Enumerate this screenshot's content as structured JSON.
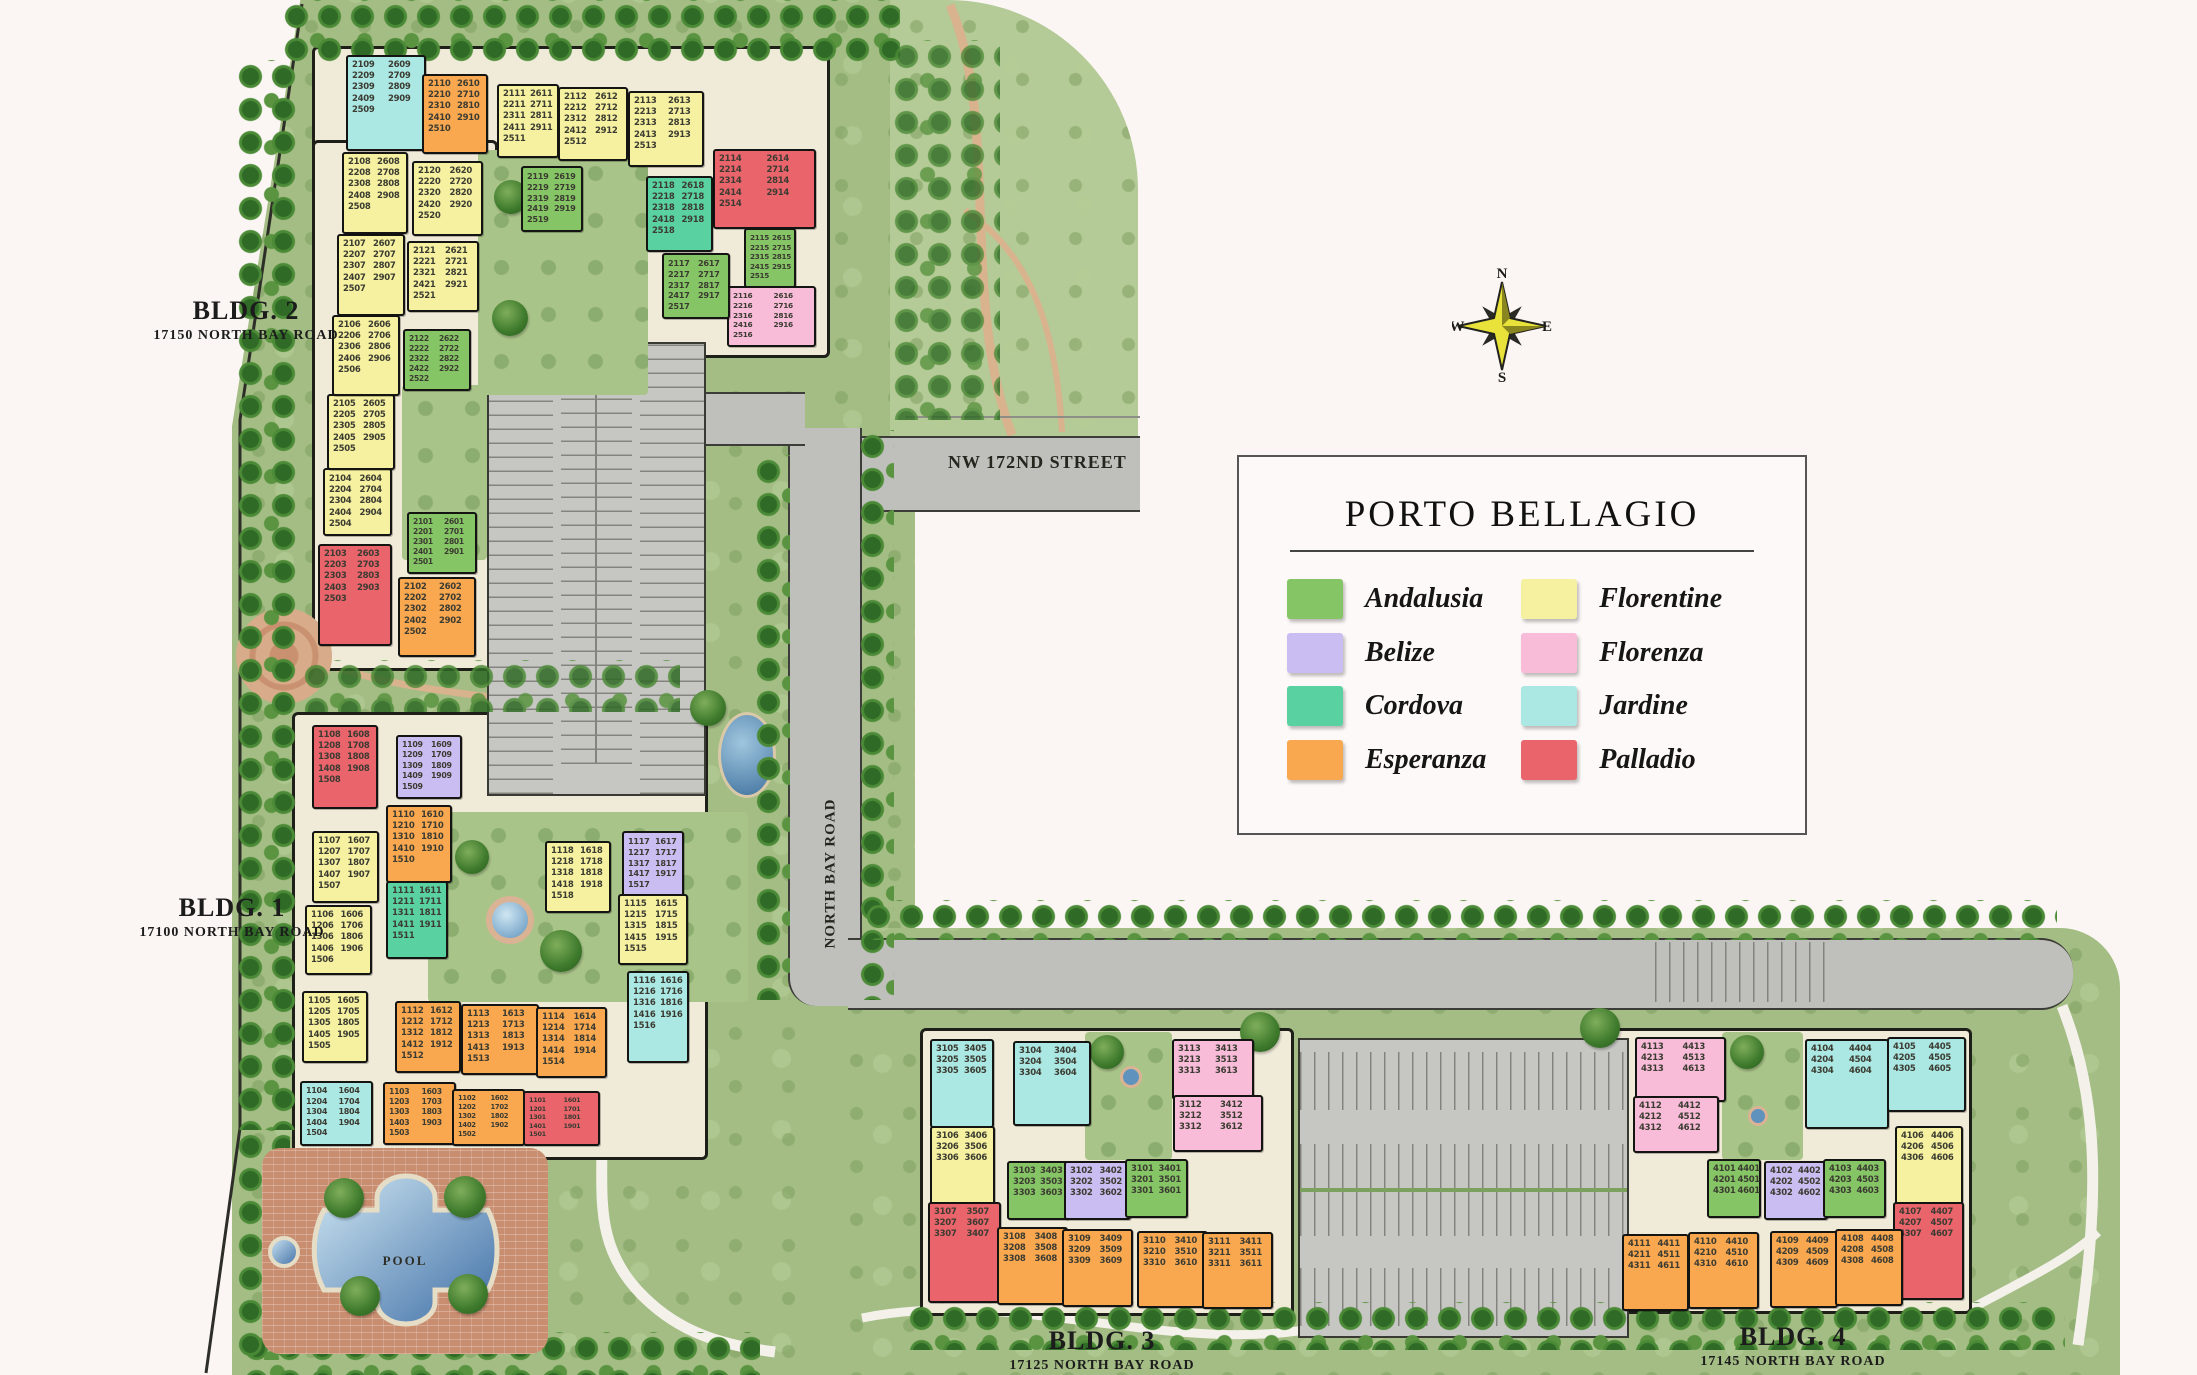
{
  "title": "PORTO BELLAGIO",
  "legend": {
    "title": "PORTO BELLAGIO",
    "entries": [
      {
        "name": "Andalusia",
        "color": "#85c565"
      },
      {
        "name": "Belize",
        "color": "#c9bdf1"
      },
      {
        "name": "Cordova",
        "color": "#5ad1a1"
      },
      {
        "name": "Esperanza",
        "color": "#f9a850"
      },
      {
        "name": "Florentine",
        "color": "#f5f1a0"
      },
      {
        "name": "Florenza",
        "color": "#f8bcd9"
      },
      {
        "name": "Jardine",
        "color": "#abe8e4"
      },
      {
        "name": "Palladio",
        "color": "#ea646c"
      }
    ]
  },
  "streets": {
    "nw_172nd": "NW 172ND STREET",
    "north_bay": "NORTH BAY ROAD"
  },
  "pool": {
    "label": "POOL"
  },
  "compass": {
    "n": "N",
    "e": "E",
    "s": "S",
    "w": "W"
  },
  "buildings": [
    {
      "id": "bldg-2",
      "label": "BLDG. 2",
      "address": "17150 NORTH BAY ROAD",
      "label_x": 246,
      "label_y": 296
    },
    {
      "id": "bldg-1",
      "label": "BLDG. 1",
      "address": "17100 NORTH BAY ROAD",
      "label_x": 232,
      "label_y": 893
    },
    {
      "id": "bldg-3",
      "label": "BLDG. 3",
      "address": "17125 NORTH BAY ROAD",
      "label_x": 1102,
      "label_y": 1326
    },
    {
      "id": "bldg-4",
      "label": "BLDG. 4",
      "address": "17145 NORTH BAY ROAD",
      "label_x": 1793,
      "label_y": 1322
    }
  ],
  "unit_blocks": [
    {
      "building": "bldg-2",
      "type": "Andalusia",
      "x": 407,
      "y": 512,
      "w": 66,
      "h": 58,
      "units": [
        "2101",
        "2601",
        "2201",
        "2701",
        "2301",
        "2801",
        "2401",
        "2901",
        "2501"
      ]
    },
    {
      "building": "bldg-2",
      "type": "Esperanza",
      "x": 398,
      "y": 577,
      "w": 74,
      "h": 76,
      "units": [
        "2102",
        "2602",
        "2202",
        "2702",
        "2302",
        "2802",
        "2402",
        "2902",
        "2502"
      ]
    },
    {
      "building": "bldg-2",
      "type": "Palladio",
      "x": 318,
      "y": 544,
      "w": 70,
      "h": 98,
      "units": [
        "2103",
        "2603",
        "2203",
        "2703",
        "2303",
        "2803",
        "2403",
        "2903",
        "2503"
      ]
    },
    {
      "building": "bldg-2",
      "type": "Florentine",
      "x": 323,
      "y": 468,
      "w": 65,
      "h": 64,
      "units": [
        "2104",
        "2604",
        "2204",
        "2704",
        "2304",
        "2804",
        "2404",
        "2904",
        "2504"
      ]
    },
    {
      "building": "bldg-2",
      "type": "Florentine",
      "x": 327,
      "y": 394,
      "w": 64,
      "h": 72,
      "units": [
        "2105",
        "2605",
        "2205",
        "2705",
        "2305",
        "2805",
        "2405",
        "2905",
        "2505"
      ]
    },
    {
      "building": "bldg-2",
      "type": "Florentine",
      "x": 332,
      "y": 315,
      "w": 64,
      "h": 77,
      "units": [
        "2106",
        "2606",
        "2206",
        "2706",
        "2306",
        "2806",
        "2406",
        "2906",
        "2506"
      ]
    },
    {
      "building": "bldg-2",
      "type": "Florentine",
      "x": 337,
      "y": 234,
      "w": 64,
      "h": 78,
      "units": [
        "2107",
        "2607",
        "2207",
        "2707",
        "2307",
        "2807",
        "2407",
        "2907",
        "2507"
      ]
    },
    {
      "building": "bldg-2",
      "type": "Florentine",
      "x": 342,
      "y": 152,
      "w": 62,
      "h": 78,
      "units": [
        "2108",
        "2608",
        "2208",
        "2708",
        "2308",
        "2808",
        "2408",
        "2908",
        "2508"
      ]
    },
    {
      "building": "bldg-2",
      "type": "Jardine",
      "x": 346,
      "y": 55,
      "w": 76,
      "h": 92,
      "units": [
        "2109",
        "2609",
        "2209",
        "2709",
        "2309",
        "2809",
        "2409",
        "2909",
        "2509"
      ]
    },
    {
      "building": "bldg-2",
      "type": "Esperanza",
      "x": 422,
      "y": 74,
      "w": 62,
      "h": 76,
      "units": [
        "2110",
        "2610",
        "2210",
        "2710",
        "2310",
        "2810",
        "2410",
        "2910",
        "2510"
      ]
    },
    {
      "building": "bldg-2",
      "type": "Florentine",
      "x": 497,
      "y": 84,
      "w": 58,
      "h": 70,
      "units": [
        "2111",
        "2611",
        "2211",
        "2711",
        "2311",
        "2811",
        "2411",
        "2911",
        "2511"
      ]
    },
    {
      "building": "bldg-2",
      "type": "Florentine",
      "x": 558,
      "y": 87,
      "w": 66,
      "h": 70,
      "units": [
        "2112",
        "2612",
        "2212",
        "2712",
        "2312",
        "2812",
        "2412",
        "2912",
        "2512"
      ]
    },
    {
      "building": "bldg-2",
      "type": "Florentine",
      "x": 628,
      "y": 91,
      "w": 72,
      "h": 72,
      "units": [
        "2113",
        "2613",
        "2213",
        "2713",
        "2313",
        "2813",
        "2413",
        "2913",
        "2513"
      ]
    },
    {
      "building": "bldg-2",
      "type": "Palladio",
      "x": 713,
      "y": 149,
      "w": 99,
      "h": 76,
      "units": [
        "2114",
        "2614",
        "2214",
        "2714",
        "2314",
        "2814",
        "2414",
        "2914",
        "2514"
      ]
    },
    {
      "building": "bldg-2",
      "type": "Andalusia",
      "x": 744,
      "y": 228,
      "w": 48,
      "h": 56,
      "units": [
        "2115",
        "2615",
        "2215",
        "2715",
        "2315",
        "2815",
        "2415",
        "2915",
        "2515"
      ]
    },
    {
      "building": "bldg-2",
      "type": "Florenza",
      "x": 727,
      "y": 286,
      "w": 85,
      "h": 57,
      "units": [
        "2116",
        "2616",
        "2216",
        "2716",
        "2316",
        "2816",
        "2416",
        "2916",
        "2516"
      ]
    },
    {
      "building": "bldg-2",
      "type": "Andalusia",
      "x": 662,
      "y": 253,
      "w": 64,
      "h": 62,
      "units": [
        "2117",
        "2617",
        "2217",
        "2717",
        "2317",
        "2817",
        "2417",
        "2917",
        "2517"
      ]
    },
    {
      "building": "bldg-2",
      "type": "Cordova",
      "x": 646,
      "y": 176,
      "w": 63,
      "h": 72,
      "units": [
        "2118",
        "2618",
        "2218",
        "2718",
        "2318",
        "2818",
        "2418",
        "2918",
        "2518"
      ]
    },
    {
      "building": "bldg-2",
      "type": "Andalusia",
      "x": 521,
      "y": 166,
      "w": 58,
      "h": 62,
      "units": [
        "2119",
        "2619",
        "2219",
        "2719",
        "2319",
        "2819",
        "2419",
        "2919",
        "2519"
      ]
    },
    {
      "building": "bldg-2",
      "type": "Florentine",
      "x": 412,
      "y": 161,
      "w": 67,
      "h": 71,
      "units": [
        "2120",
        "2620",
        "2220",
        "2720",
        "2320",
        "2820",
        "2420",
        "2920",
        "2520"
      ]
    },
    {
      "building": "bldg-2",
      "type": "Florentine",
      "x": 407,
      "y": 241,
      "w": 68,
      "h": 67,
      "units": [
        "2121",
        "2621",
        "2221",
        "2721",
        "2321",
        "2821",
        "2421",
        "2921",
        "2521"
      ]
    },
    {
      "building": "bldg-2",
      "type": "Andalusia",
      "x": 403,
      "y": 329,
      "w": 64,
      "h": 58,
      "units": [
        "2122",
        "2622",
        "2222",
        "2722",
        "2322",
        "2822",
        "2422",
        "2922",
        "2522"
      ]
    },
    {
      "building": "bldg-1",
      "type": "Palladio",
      "x": 312,
      "y": 725,
      "w": 62,
      "h": 80,
      "units": [
        "1108",
        "1608",
        "1208",
        "1708",
        "1308",
        "1808",
        "1408",
        "1908",
        "1508"
      ]
    },
    {
      "building": "bldg-1",
      "type": "Belize",
      "x": 396,
      "y": 735,
      "w": 62,
      "h": 60,
      "units": [
        "1109",
        "1609",
        "1209",
        "1709",
        "1309",
        "1809",
        "1409",
        "1909",
        "1509"
      ]
    },
    {
      "building": "bldg-1",
      "type": "Esperanza",
      "x": 386,
      "y": 805,
      "w": 62,
      "h": 74,
      "units": [
        "1110",
        "1610",
        "1210",
        "1710",
        "1310",
        "1810",
        "1410",
        "1910",
        "1510"
      ]
    },
    {
      "building": "bldg-1",
      "type": "Cordova",
      "x": 386,
      "y": 881,
      "w": 58,
      "h": 74,
      "units": [
        "1111",
        "1611",
        "1211",
        "1711",
        "1311",
        "1811",
        "1411",
        "1911",
        "1511"
      ]
    },
    {
      "building": "bldg-1",
      "type": "Florentine",
      "x": 312,
      "y": 831,
      "w": 63,
      "h": 68,
      "units": [
        "1107",
        "1607",
        "1207",
        "1707",
        "1307",
        "1807",
        "1407",
        "1907",
        "1507"
      ]
    },
    {
      "building": "bldg-1",
      "type": "Florentine",
      "x": 305,
      "y": 905,
      "w": 63,
      "h": 66,
      "units": [
        "1106",
        "1606",
        "1206",
        "1706",
        "1306",
        "1806",
        "1406",
        "1906",
        "1506"
      ]
    },
    {
      "building": "bldg-1",
      "type": "Florentine",
      "x": 302,
      "y": 991,
      "w": 62,
      "h": 68,
      "units": [
        "1105",
        "1605",
        "1205",
        "1705",
        "1305",
        "1805",
        "1405",
        "1905",
        "1505"
      ]
    },
    {
      "building": "bldg-1",
      "type": "Florentine",
      "x": 545,
      "y": 841,
      "w": 62,
      "h": 68,
      "units": [
        "1118",
        "1618",
        "1218",
        "1718",
        "1318",
        "1818",
        "1418",
        "1918",
        "1518"
      ]
    },
    {
      "building": "bldg-1",
      "type": "Belize",
      "x": 622,
      "y": 831,
      "w": 58,
      "h": 62,
      "units": [
        "1117",
        "1617",
        "1217",
        "1717",
        "1317",
        "1817",
        "1417",
        "1917",
        "1517"
      ]
    },
    {
      "building": "bldg-1",
      "type": "Florentine",
      "x": 618,
      "y": 894,
      "w": 66,
      "h": 67,
      "units": [
        "1115",
        "1615",
        "1215",
        "1715",
        "1315",
        "1815",
        "1415",
        "1915",
        "1515"
      ]
    },
    {
      "building": "bldg-1",
      "type": "Jardine",
      "x": 627,
      "y": 971,
      "w": 58,
      "h": 88,
      "units": [
        "1116",
        "1616",
        "1216",
        "1716",
        "1316",
        "1816",
        "1416",
        "1916",
        "1516"
      ]
    },
    {
      "building": "bldg-1",
      "type": "Esperanza",
      "x": 395,
      "y": 1001,
      "w": 62,
      "h": 68,
      "units": [
        "1112",
        "1612",
        "1212",
        "1712",
        "1312",
        "1812",
        "1412",
        "1912",
        "1512"
      ]
    },
    {
      "building": "bldg-1",
      "type": "Esperanza",
      "x": 461,
      "y": 1004,
      "w": 74,
      "h": 67,
      "units": [
        "1113",
        "1613",
        "1213",
        "1713",
        "1313",
        "1813",
        "1413",
        "1913",
        "1513"
      ]
    },
    {
      "building": "bldg-1",
      "type": "Esperanza",
      "x": 536,
      "y": 1007,
      "w": 67,
      "h": 67,
      "units": [
        "1114",
        "1614",
        "1214",
        "1714",
        "1314",
        "1814",
        "1414",
        "1914",
        "1514"
      ]
    },
    {
      "building": "bldg-1",
      "type": "Jardine",
      "x": 300,
      "y": 1081,
      "w": 69,
      "h": 61,
      "units": [
        "1104",
        "1604",
        "1204",
        "1704",
        "1304",
        "1804",
        "1404",
        "1904",
        "1504"
      ]
    },
    {
      "building": "bldg-1",
      "type": "Esperanza",
      "x": 383,
      "y": 1082,
      "w": 69,
      "h": 59,
      "units": [
        "1103",
        "1603",
        "1203",
        "1703",
        "1303",
        "1803",
        "1403",
        "1903",
        "1503"
      ]
    },
    {
      "building": "bldg-1",
      "type": "Esperanza",
      "x": 452,
      "y": 1089,
      "w": 69,
      "h": 53,
      "units": [
        "1102",
        "1602",
        "1202",
        "1702",
        "1302",
        "1802",
        "1402",
        "1902",
        "1502"
      ]
    },
    {
      "building": "bldg-1",
      "type": "Palladio",
      "x": 523,
      "y": 1091,
      "w": 73,
      "h": 51,
      "units": [
        "1101",
        "1601",
        "1201",
        "1701",
        "1301",
        "1801",
        "1401",
        "1901",
        "1501"
      ]
    },
    {
      "building": "bldg-3",
      "type": "Jardine",
      "x": 930,
      "y": 1039,
      "w": 60,
      "h": 85,
      "units": [
        "3105",
        "3405",
        "3205",
        "3505",
        "3305",
        "3605"
      ]
    },
    {
      "building": "bldg-3",
      "type": "Jardine",
      "x": 1013,
      "y": 1041,
      "w": 74,
      "h": 81,
      "units": [
        "3104",
        "3404",
        "3204",
        "3504",
        "3304",
        "3604"
      ]
    },
    {
      "building": "bldg-3",
      "type": "Florenza",
      "x": 1172,
      "y": 1039,
      "w": 78,
      "h": 57,
      "units": [
        "3113",
        "3413",
        "3213",
        "3513",
        "3313",
        "3613"
      ]
    },
    {
      "building": "bldg-3",
      "type": "Florenza",
      "x": 1173,
      "y": 1095,
      "w": 86,
      "h": 53,
      "units": [
        "3112",
        "3412",
        "3212",
        "3512",
        "3312",
        "3612"
      ]
    },
    {
      "building": "bldg-3",
      "type": "Florentine",
      "x": 930,
      "y": 1126,
      "w": 61,
      "h": 77,
      "units": [
        "3106",
        "3406",
        "3206",
        "3506",
        "3306",
        "3606"
      ]
    },
    {
      "building": "bldg-3",
      "type": "Palladio",
      "x": 928,
      "y": 1202,
      "w": 69,
      "h": 97,
      "units": [
        "3107",
        "3507",
        "3207",
        "3607",
        "3307",
        "3407"
      ]
    },
    {
      "building": "bldg-3",
      "type": "Andalusia",
      "x": 1007,
      "y": 1161,
      "w": 58,
      "h": 55,
      "units": [
        "3103",
        "3403",
        "3203",
        "3503",
        "3303",
        "3603"
      ]
    },
    {
      "building": "bldg-3",
      "type": "Belize",
      "x": 1064,
      "y": 1161,
      "w": 63,
      "h": 55,
      "units": [
        "3102",
        "3402",
        "3202",
        "3502",
        "3302",
        "3602"
      ]
    },
    {
      "building": "bldg-3",
      "type": "Andalusia",
      "x": 1125,
      "y": 1159,
      "w": 59,
      "h": 55,
      "units": [
        "3101",
        "3401",
        "3201",
        "3501",
        "3301",
        "3601"
      ]
    },
    {
      "building": "bldg-3",
      "type": "Esperanza",
      "x": 997,
      "y": 1227,
      "w": 67,
      "h": 74,
      "units": [
        "3108",
        "3408",
        "3208",
        "3508",
        "3308",
        "3608"
      ]
    },
    {
      "building": "bldg-3",
      "type": "Esperanza",
      "x": 1062,
      "y": 1229,
      "w": 67,
      "h": 74,
      "units": [
        "3109",
        "3409",
        "3209",
        "3509",
        "3309",
        "3609"
      ]
    },
    {
      "building": "bldg-3",
      "type": "Esperanza",
      "x": 1137,
      "y": 1231,
      "w": 67,
      "h": 73,
      "units": [
        "3110",
        "3410",
        "3210",
        "3510",
        "3310",
        "3610"
      ]
    },
    {
      "building": "bldg-3",
      "type": "Esperanza",
      "x": 1202,
      "y": 1232,
      "w": 67,
      "h": 73,
      "units": [
        "3111",
        "3411",
        "3211",
        "3511",
        "3311",
        "3611"
      ]
    },
    {
      "building": "bldg-4",
      "type": "Florenza",
      "x": 1635,
      "y": 1037,
      "w": 87,
      "h": 61,
      "units": [
        "4113",
        "4413",
        "4213",
        "4513",
        "4313",
        "4613"
      ]
    },
    {
      "building": "bldg-4",
      "type": "Florenza",
      "x": 1633,
      "y": 1096,
      "w": 82,
      "h": 53,
      "units": [
        "4112",
        "4412",
        "4212",
        "4512",
        "4312",
        "4612"
      ]
    },
    {
      "building": "bldg-4",
      "type": "Jardine",
      "x": 1805,
      "y": 1039,
      "w": 80,
      "h": 86,
      "units": [
        "4104",
        "4404",
        "4204",
        "4504",
        "4304",
        "4604"
      ]
    },
    {
      "building": "bldg-4",
      "type": "Jardine",
      "x": 1887,
      "y": 1037,
      "w": 75,
      "h": 71,
      "units": [
        "4105",
        "4405",
        "4205",
        "4505",
        "4305",
        "4605"
      ]
    },
    {
      "building": "bldg-4",
      "type": "Florentine",
      "x": 1895,
      "y": 1126,
      "w": 64,
      "h": 77,
      "units": [
        "4106",
        "4406",
        "4206",
        "4506",
        "4306",
        "4606"
      ]
    },
    {
      "building": "bldg-4",
      "type": "Palladio",
      "x": 1893,
      "y": 1202,
      "w": 67,
      "h": 94,
      "units": [
        "4107",
        "4407",
        "4207",
        "4507",
        "4307",
        "4607"
      ]
    },
    {
      "building": "bldg-4",
      "type": "Andalusia",
      "x": 1707,
      "y": 1159,
      "w": 50,
      "h": 55,
      "units": [
        "4101",
        "4401",
        "4201",
        "4501",
        "4301",
        "4601"
      ]
    },
    {
      "building": "bldg-4",
      "type": "Belize",
      "x": 1764,
      "y": 1161,
      "w": 60,
      "h": 55,
      "units": [
        "4102",
        "4402",
        "4202",
        "4502",
        "4302",
        "4602"
      ]
    },
    {
      "building": "bldg-4",
      "type": "Andalusia",
      "x": 1823,
      "y": 1159,
      "w": 59,
      "h": 55,
      "units": [
        "4103",
        "4403",
        "4203",
        "4503",
        "4303",
        "4603"
      ]
    },
    {
      "building": "bldg-4",
      "type": "Esperanza",
      "x": 1622,
      "y": 1234,
      "w": 63,
      "h": 73,
      "units": [
        "4111",
        "4411",
        "4211",
        "4511",
        "4311",
        "4611"
      ]
    },
    {
      "building": "bldg-4",
      "type": "Esperanza",
      "x": 1688,
      "y": 1232,
      "w": 67,
      "h": 73,
      "units": [
        "4110",
        "4410",
        "4210",
        "4510",
        "4310",
        "4610"
      ]
    },
    {
      "building": "bldg-4",
      "type": "Esperanza",
      "x": 1770,
      "y": 1231,
      "w": 64,
      "h": 73,
      "units": [
        "4109",
        "4409",
        "4209",
        "4509",
        "4309",
        "4609"
      ]
    },
    {
      "building": "bldg-4",
      "type": "Esperanza",
      "x": 1835,
      "y": 1229,
      "w": 64,
      "h": 73,
      "units": [
        "4108",
        "4408",
        "4208",
        "4508",
        "4308",
        "4608"
      ]
    }
  ]
}
